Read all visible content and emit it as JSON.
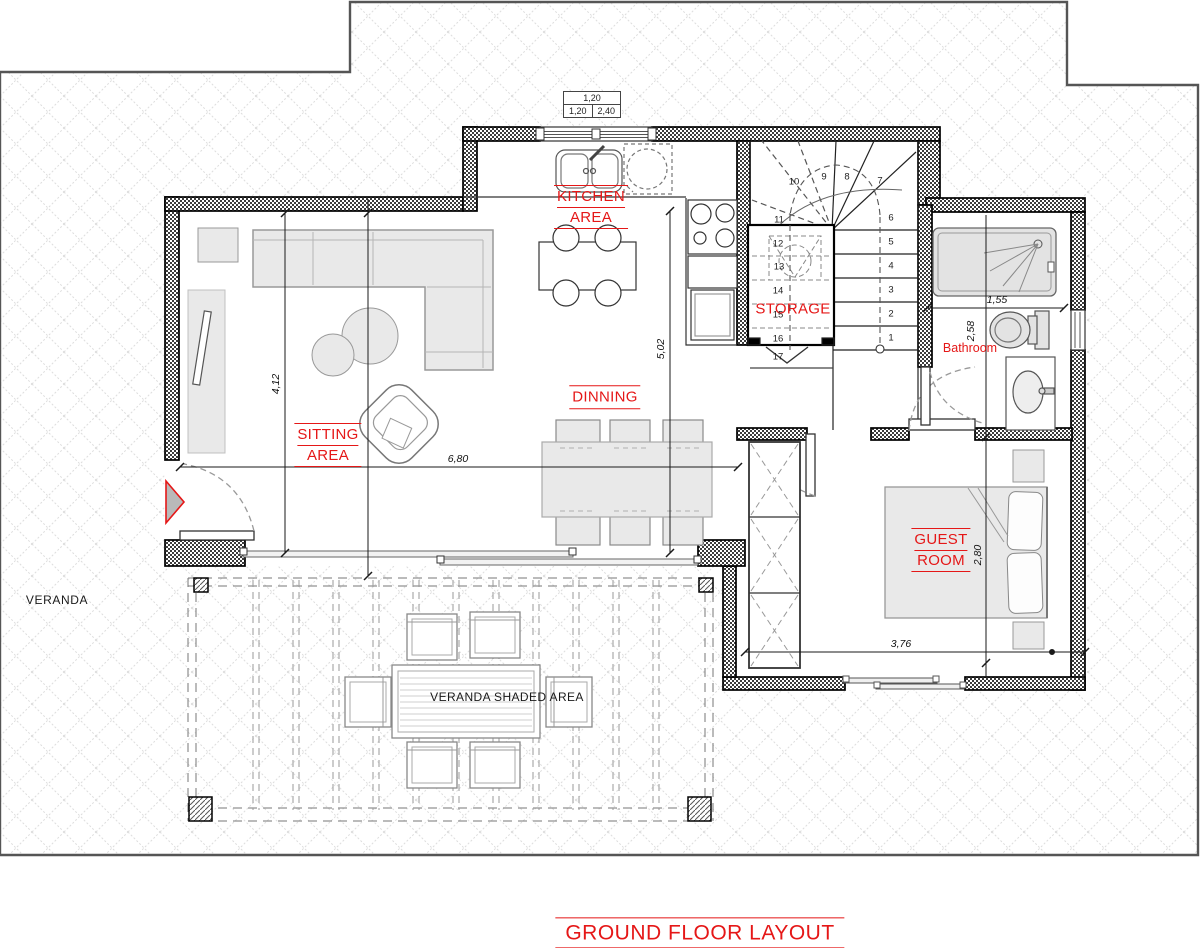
{
  "plan": {
    "title": "GROUND FLOOR LAYOUT",
    "rooms": {
      "kitchen": {
        "line1": "KITCHEN",
        "line2": "AREA"
      },
      "sitting": {
        "line1": "SITTING",
        "line2": "AREA"
      },
      "dining": {
        "label": "DINNING"
      },
      "storage": {
        "label": "STORAGE"
      },
      "bathroom": {
        "label": "Bathroom"
      },
      "guest": {
        "line1": "GUEST",
        "line2": "ROOM"
      },
      "veranda": {
        "label": "VERANDA"
      },
      "veranda_shaded": {
        "label": "VERANDA SHADED AREA"
      }
    },
    "dimensions": {
      "top_table": {
        "row1": "1,20",
        "row2_left": "1,20",
        "row2_right": "2,40"
      },
      "living_width": "6,80",
      "living_height": "4,12",
      "dining_height": "5,02",
      "bathroom_width": "1,55",
      "bathroom_height": "2,58",
      "guest_height": "2,80",
      "guest_width": "3,76"
    },
    "stairs": {
      "numbers": [
        "1",
        "2",
        "3",
        "4",
        "5",
        "6",
        "7",
        "8",
        "9",
        "10",
        "11",
        "12",
        "13",
        "14",
        "15",
        "16",
        "17"
      ]
    },
    "colors": {
      "label_red": "#e51717",
      "wall": "#000000",
      "furniture_fill": "#e9e9e9",
      "terrain_line": "#dddddd",
      "boundary": "#555555"
    }
  }
}
